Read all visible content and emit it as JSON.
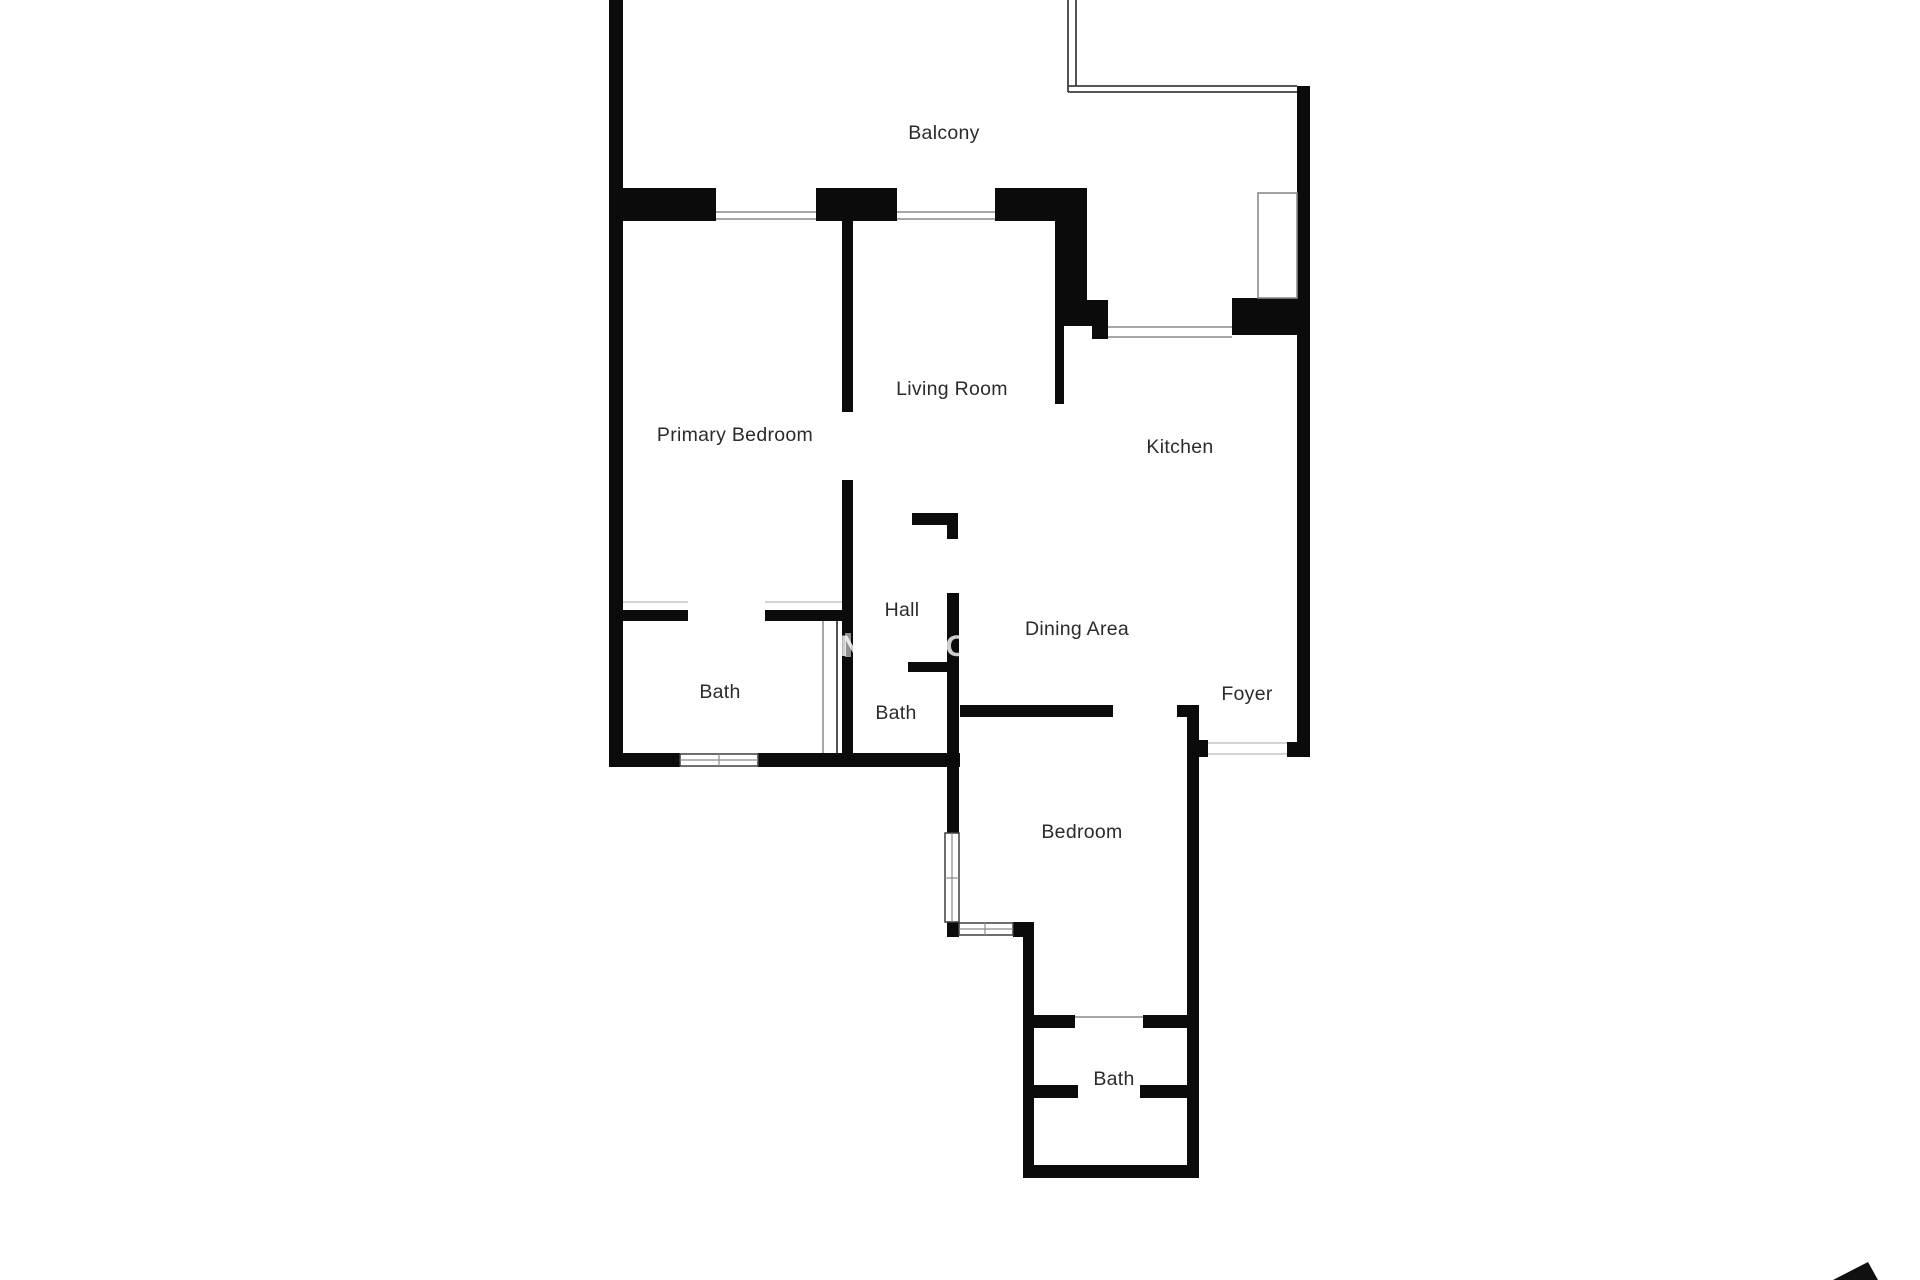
{
  "plan": {
    "title": "Apartment floor plan",
    "rooms": [
      {
        "id": "balcony",
        "label": "Balcony"
      },
      {
        "id": "primary-bedroom",
        "label": "Primary Bedroom"
      },
      {
        "id": "living-room",
        "label": "Living Room"
      },
      {
        "id": "kitchen",
        "label": "Kitchen"
      },
      {
        "id": "hall",
        "label": "Hall"
      },
      {
        "id": "dining-area",
        "label": "Dining Area"
      },
      {
        "id": "bath-primary",
        "label": "Bath"
      },
      {
        "id": "bath-hall",
        "label": "Bath"
      },
      {
        "id": "foyer",
        "label": "Foyer"
      },
      {
        "id": "bedroom",
        "label": "Bedroom"
      },
      {
        "id": "bath-bedroom",
        "label": "Bath"
      }
    ],
    "watermark": {
      "letters": [
        {
          "char": "N"
        },
        {
          "char": "O"
        }
      ]
    },
    "colors": {
      "background": "#ffffff",
      "wall": "#0b0b0b",
      "line_dark": "#3f3f3f",
      "line_mid": "#8a8a8a",
      "line_light": "#c6c6c6",
      "label": "#2b2b2b",
      "door_leaf": "#909090",
      "arrow": "#101010"
    }
  }
}
